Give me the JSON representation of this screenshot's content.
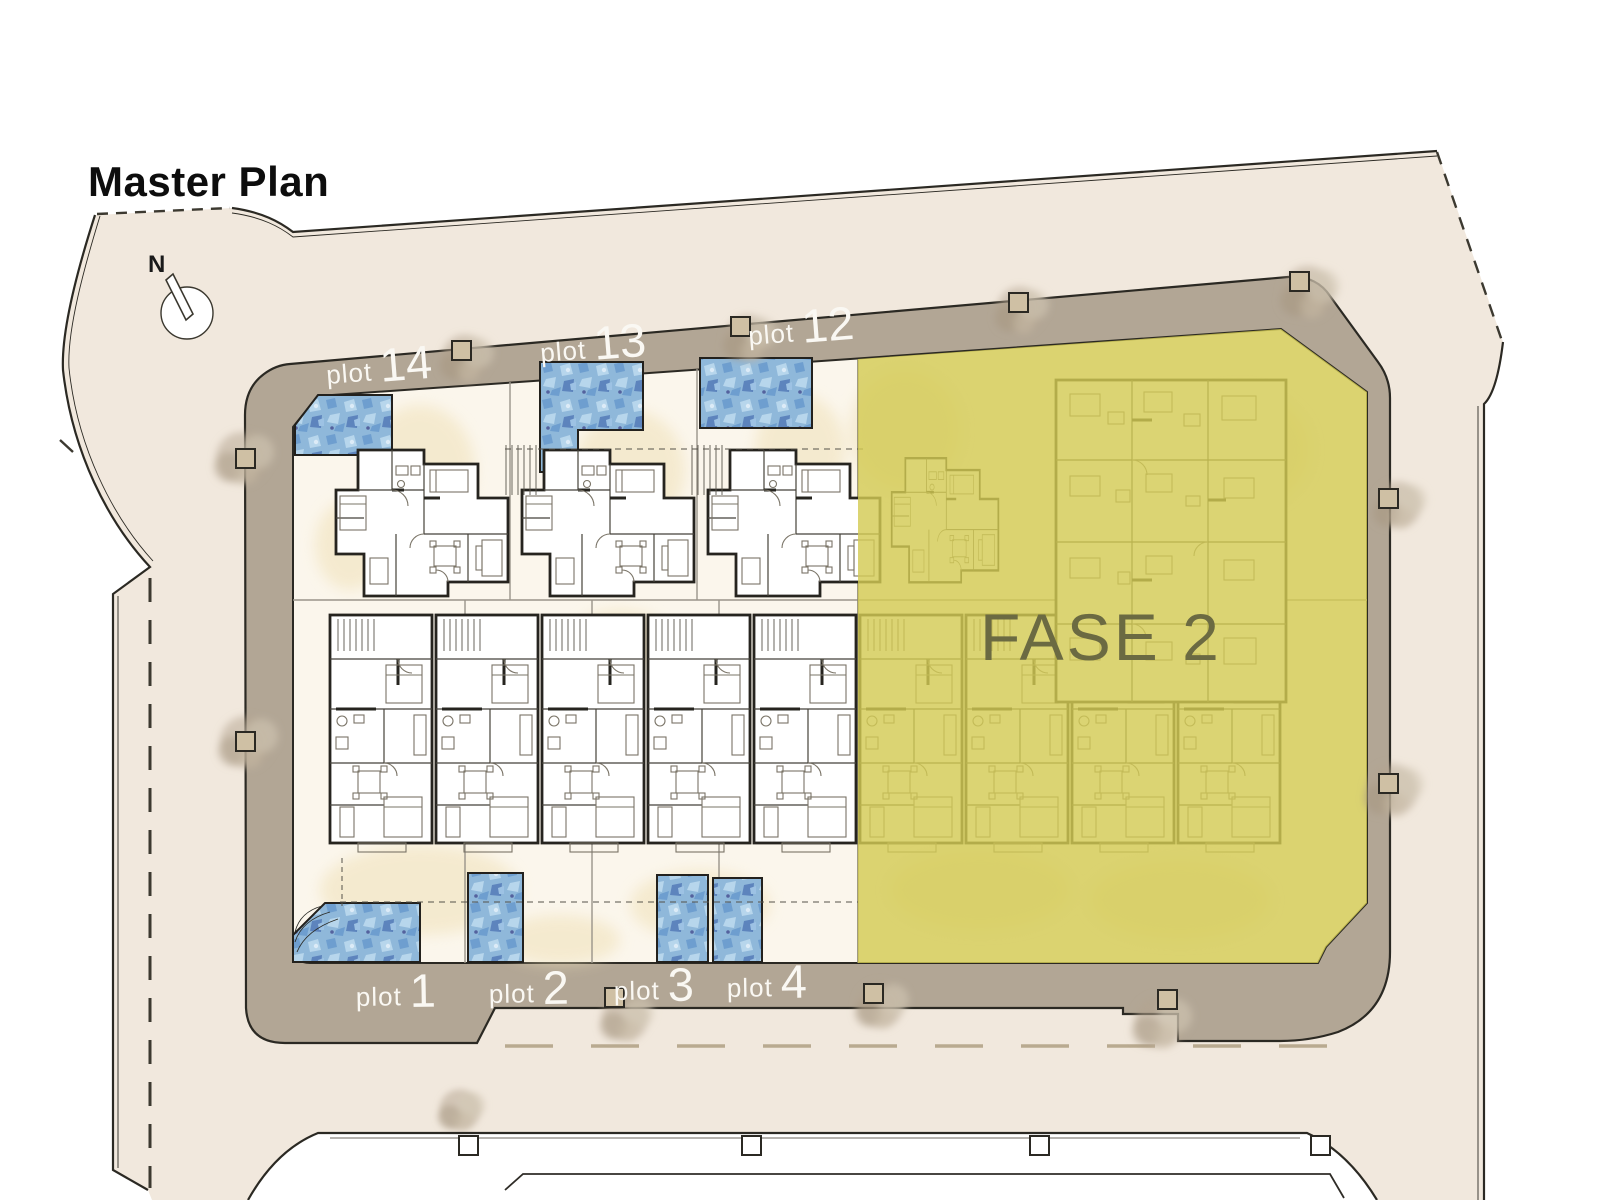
{
  "title": "Master Plan",
  "compass": {
    "north_label": "N"
  },
  "phase": {
    "label": "FASE 2",
    "fill": "#d3cb54",
    "text_color": "#6b6a42"
  },
  "plot_word": "plot",
  "plots_top": [
    {
      "number": "14"
    },
    {
      "number": "13"
    },
    {
      "number": "12"
    }
  ],
  "plots_bottom": [
    {
      "number": "1"
    },
    {
      "number": "2"
    },
    {
      "number": "3"
    },
    {
      "number": "4"
    }
  ],
  "colors": {
    "road": "#f1e8dd",
    "sidewalk": "#b2a695",
    "site_ground": "#fbf6ec",
    "pool_base": "#8fb8da",
    "outline": "#2b2923",
    "sand": "#f0e1b8"
  }
}
